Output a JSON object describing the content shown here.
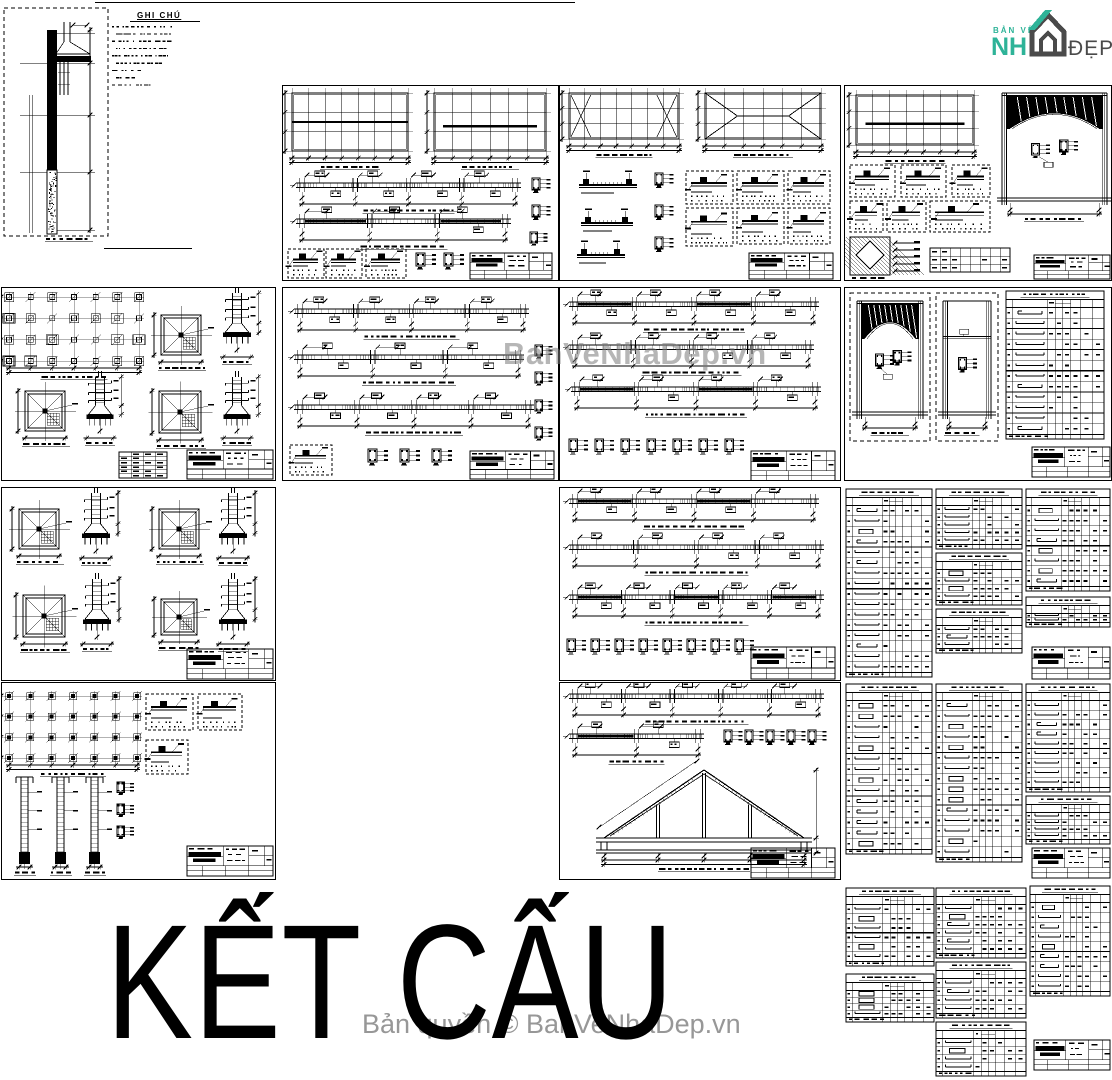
{
  "page": {
    "background": "#ffffff",
    "title_hero": "KẾT CẤU"
  },
  "logo": {
    "top_text": "BẢN VẼ",
    "main_text": "NH",
    "suffix_text": "ĐẸP",
    "teal": "#2eb398",
    "dark": "#4a4a4a"
  },
  "watermarks": {
    "center_text": "BanVeNhaDep.vn",
    "copyright_text": "Bản quyền © BanVeNhaDep.vn",
    "color": "#8a8a8a"
  },
  "notes": {
    "heading": "GHI CHÚ"
  },
  "drawing": {
    "line_color": "#000000",
    "paper_color": "#ffffff"
  }
}
